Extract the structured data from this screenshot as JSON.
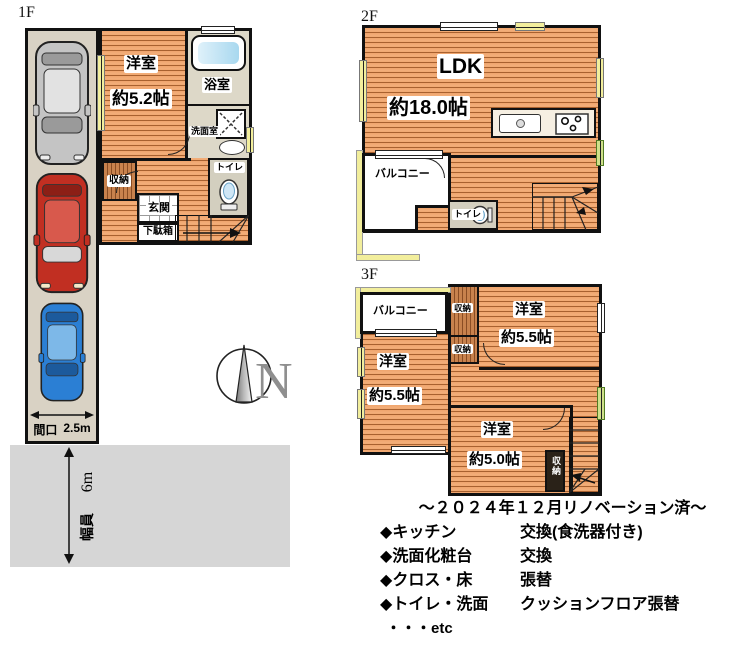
{
  "floors": {
    "f1": {
      "label": "1F",
      "bedroom": {
        "name": "洋室",
        "size": "約5.2帖"
      },
      "bath": "浴室",
      "washroom": "洗面室",
      "closet": "収納",
      "toilet": "トイレ",
      "entrance": "玄関",
      "shoebox": "下駄箱",
      "frontage_label": "間口",
      "frontage_value": "2.5m"
    },
    "f2": {
      "label": "2F",
      "ldk": {
        "name": "LDK",
        "size": "約18.0帖"
      },
      "balcony": "バルコニー",
      "toilet": "トイレ"
    },
    "f3": {
      "label": "3F",
      "balcony": "バルコニー",
      "closet_a": "収納",
      "closet_b": "収納",
      "closet_c": "収納",
      "bedroom_right": {
        "name": "洋室",
        "size": "約5.5帖"
      },
      "bedroom_left": {
        "name": "洋室",
        "size": "約5.5帖"
      },
      "bedroom_bottom": {
        "name": "洋室",
        "size": "約5.0帖"
      }
    }
  },
  "site": {
    "road_width": "6m",
    "road_width_label": "幅員"
  },
  "compass": {
    "north_label": "N"
  },
  "renovation": {
    "title": "～２０２４年１２月リノベーション済～",
    "items": [
      {
        "bullet": "◆",
        "name": "キッチン",
        "detail": "交換(食洗器付き)"
      },
      {
        "bullet": "◆",
        "name": "洗面化粧台",
        "detail": "交換"
      },
      {
        "bullet": "◆",
        "name": "クロス・床",
        "detail": "張替"
      },
      {
        "bullet": "◆",
        "name": "トイレ・洗面",
        "detail": "クッションフロア張替"
      }
    ],
    "etc": "・・・etc"
  },
  "colors": {
    "wood_floor": "#efa56d",
    "wood_stripe": "#a8612f",
    "balcony_trim": "#f2ee9c",
    "window_green": "#cfe08a",
    "road_gray": "#d6d6d6",
    "driveway": "#d9d2c4"
  }
}
